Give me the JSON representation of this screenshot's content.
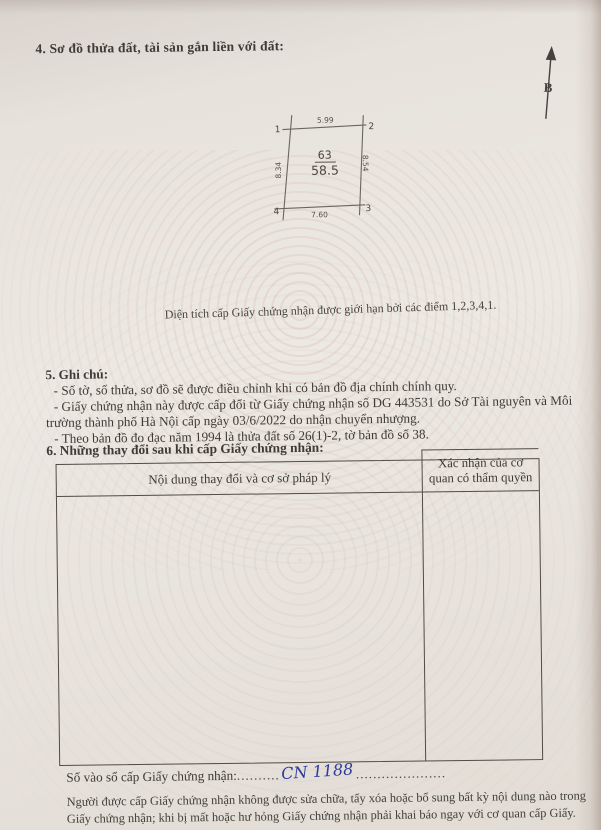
{
  "page": {
    "section4_heading": "4. Sơ đồ thửa đất, tài sản gắn liền với đất:",
    "north_label": "B",
    "diagram": {
      "corner1": "1",
      "corner2": "2",
      "corner3": "3",
      "corner4": "4",
      "dim_top": "5.99",
      "dim_bottom": "7.60",
      "dim_left": "8.34",
      "dim_right": "8.54",
      "plot_number": "63",
      "area": "58.5"
    },
    "caption": "Diện tích cấp Giấy chứng nhận được giới hạn bởi các điểm 1,2,3,4,1.",
    "section5": {
      "heading": "5. Ghi chú:",
      "notes": [
        "- Số tờ, số thửa, sơ đồ sẽ được điều chỉnh khi có bản đồ địa chính chính quy.",
        "- Giấy chứng nhận này được cấp đổi từ Giấy chứng nhận số DG 443531 do Sở Tài nguyên và Môi trường thành phố Hà Nội cấp ngày 03/6/2022 do nhận chuyển nhượng.",
        "- Theo bản đồ đo đạc năm 1994 là thửa đất số 26(1)-2, tờ bản đồ số 38."
      ]
    },
    "section6": {
      "heading": "6. Những thay đổi sau khi cấp Giấy chứng nhận:",
      "table": {
        "col1_header": "Nội dung thay đổi và cơ sở pháp lý",
        "col2_header": "Xác nhận của cơ quan có thẩm quyền"
      }
    },
    "serial": {
      "label": "Số vào sổ cấp Giấy chứng nhận:",
      "dots_before": "..........",
      "handwritten": "CN 1188",
      "dots_after": "....................."
    },
    "footer": "Người được cấp Giấy chứng nhận không được sửa chữa, tẩy xóa hoặc bổ sung bất kỳ nội dung nào trong Giấy chứng nhận; khi bị mất hoặc hư hỏng Giấy chứng nhận phải khai báo ngay với cơ quan cấp Giấy."
  },
  "colors": {
    "paper": "#e9e4df",
    "ink": "#3e3a35",
    "table_border": "#514b43",
    "handwriting_blue": "#2d3b9d",
    "guilloche_pink": "#c78b80"
  }
}
